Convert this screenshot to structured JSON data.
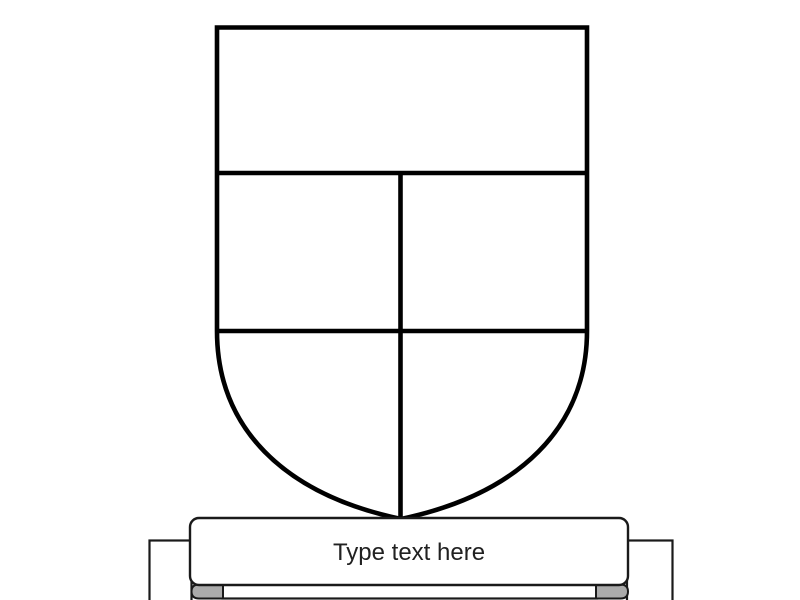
{
  "canvas": {
    "background_color": "#ffffff"
  },
  "shield": {
    "name": "quartered-shield-template",
    "fill_color": "#ffffff",
    "outline_color": "#000000",
    "sections": [
      "chief-band",
      "middle-left-quarter",
      "middle-right-quarter",
      "lower-left-quarter",
      "lower-right-quarter"
    ]
  },
  "banner": {
    "placeholder": "Type text here",
    "text_color": "#212121",
    "fill_color": "#ffffff",
    "outline_color": "#1a1a1a",
    "fold_color": "#ababab"
  }
}
